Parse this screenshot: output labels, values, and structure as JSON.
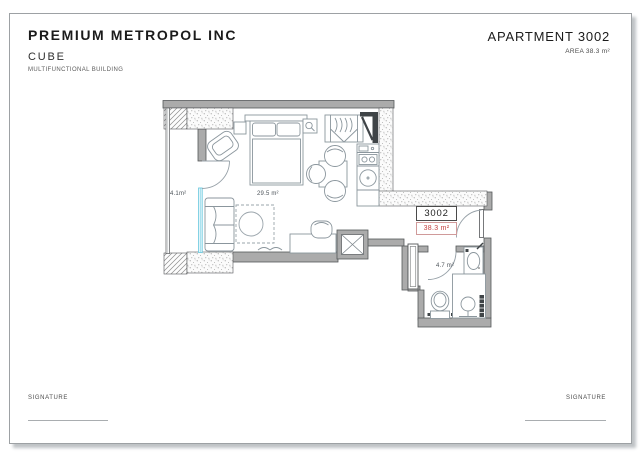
{
  "header": {
    "company": "PREMIUM METROPOL INC",
    "project": "CUBE",
    "subtitle": "MULTIFUNCTIONAL BUILDING",
    "apartment": "APARTMENT 3002",
    "area": "AREA 38.3 m²"
  },
  "plan": {
    "unit_number": "3002",
    "unit_area": "38.3 m²",
    "entry_area": "4.1m²",
    "living_area": "29.5 m²",
    "bath_area": "4.7 m²"
  },
  "footer": {
    "signature_left": "SIGNATURE",
    "signature_right": "SIGNATURE"
  },
  "colors": {
    "wall_gray": "#ababab",
    "accent_red": "#c4403f",
    "glass_cyan": "#6fcbe0",
    "line_gray": "#8b969d"
  }
}
